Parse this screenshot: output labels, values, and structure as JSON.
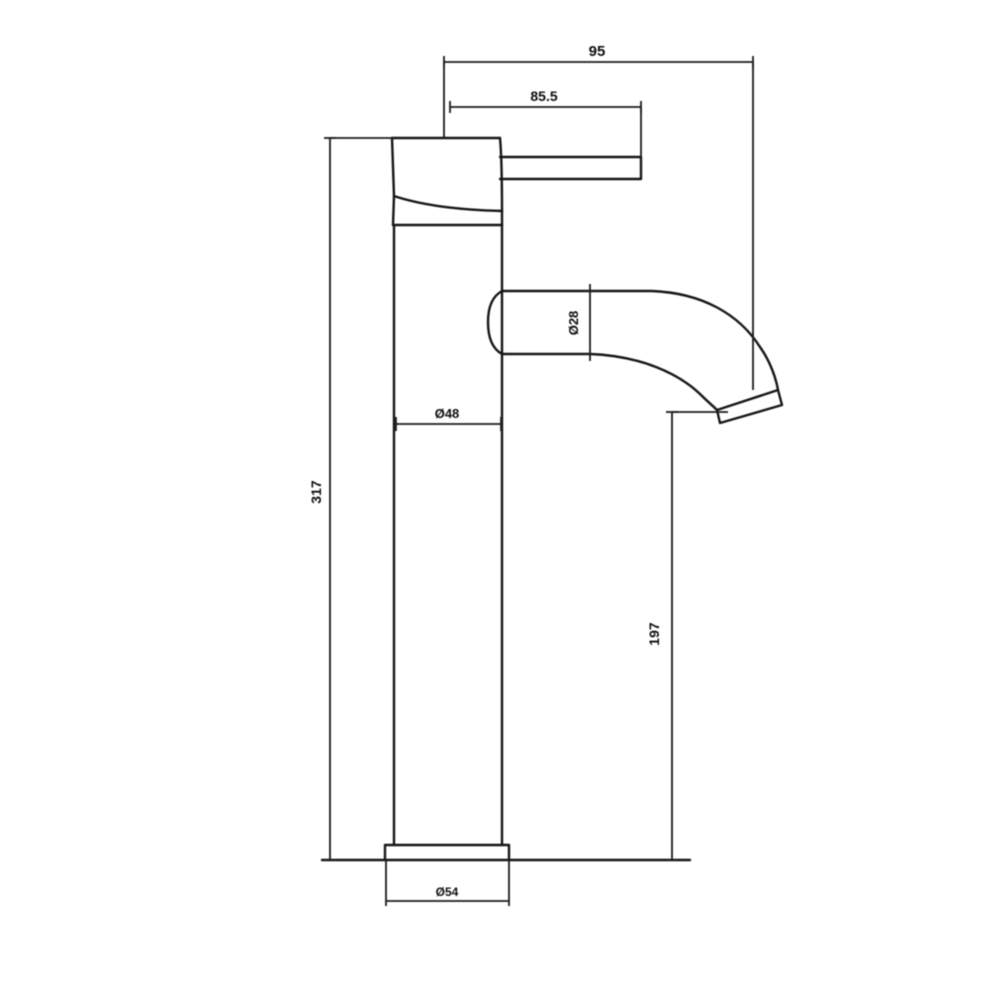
{
  "drawing": {
    "background_color": "#ffffff",
    "line_color": "#161616",
    "type": "faucet-dimensional-drawing",
    "labels": {
      "projection": "95",
      "handle_reach": "85.5",
      "overall_height": "317",
      "spout_height": "197",
      "spout_diameter": "Ø28",
      "body_diameter": "Ø48",
      "base_diameter": "Ø54"
    }
  }
}
